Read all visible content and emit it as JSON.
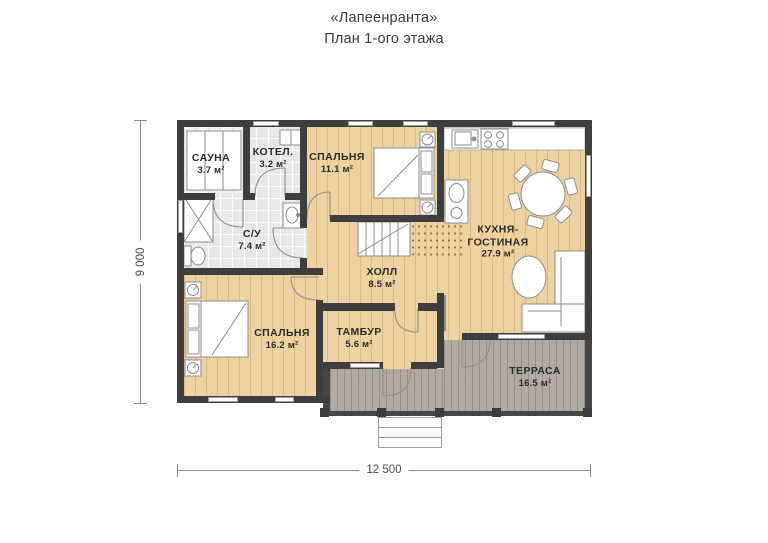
{
  "title": {
    "line1": "«Лапеенранта»",
    "line2": "План 1-ого этажа"
  },
  "dimensions": {
    "width_mm": "12 500",
    "height_mm": "9 000"
  },
  "rooms": [
    {
      "key": "sauna",
      "name": "САУНА",
      "area": "3.7 м²"
    },
    {
      "key": "boiler",
      "name": "КОТЕЛ.",
      "area": "3.2 м²"
    },
    {
      "key": "bedroom1",
      "name": "СПАЛЬНЯ",
      "area": "11.1 м²"
    },
    {
      "key": "bathroom",
      "name": "С/У",
      "area": "7.4 м²"
    },
    {
      "key": "hall",
      "name": "ХОЛЛ",
      "area": "8.5 м²"
    },
    {
      "key": "kitchen_living",
      "name": "КУХНЯ-ГОСТИНАЯ",
      "area": "27.9 м²"
    },
    {
      "key": "bedroom2",
      "name": "СПАЛЬНЯ",
      "area": "16.2 м²"
    },
    {
      "key": "vestibule",
      "name": "ТАМБУР",
      "area": "5.6 м²"
    },
    {
      "key": "terrace",
      "name": "ТЕРРАСА",
      "area": "16.5 м²"
    }
  ],
  "colors": {
    "wall": "#3f3e3e",
    "wood": "#eed3a2",
    "tile": "#e9e8e6",
    "terrace": "#b2aba1",
    "background": "#ffffff"
  }
}
